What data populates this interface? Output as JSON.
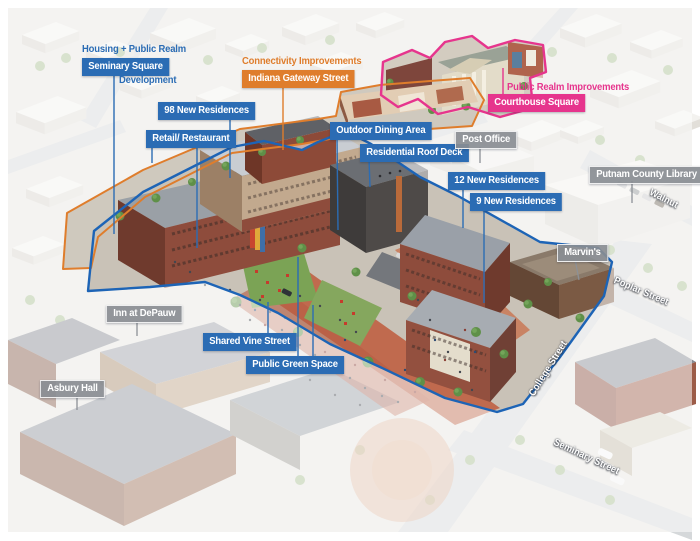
{
  "colors": {
    "callout_blue": "#2b6cb4",
    "callout_orange": "#df7d2c",
    "callout_pink": "#e6358d",
    "callout_gray": "#8d9196",
    "site_outline_blue": "#1d64b6"
  },
  "annotations": {
    "housing": {
      "heading": "Housing + Public Realm",
      "box": "Seminary Square",
      "sub": "Development"
    },
    "connectivity": {
      "heading": "Connectivity Improvements",
      "box": "Indiana Gateway Street"
    },
    "public_realm": {
      "heading": "Public Realm Improvements",
      "box": "Courthouse Square"
    }
  },
  "site_callouts": {
    "residences_98": "98 New Residences",
    "retail_restaurant": "Retail/ Restaurant",
    "outdoor_dining": "Outdoor Dining Area",
    "roof_deck": "Residential Roof Deck",
    "residences_12": "12 New Residences",
    "residences_9": "9 New Residences",
    "shared_vine": "Shared Vine Street",
    "green_space": "Public Green Space"
  },
  "context_callouts": {
    "post_office": "Post Office",
    "library": "Putnam County Library",
    "marvins": "Marvin's",
    "inn": "Inn at DePauw",
    "asbury": "Asbury Hall"
  },
  "streets": {
    "walnut": "Walnut",
    "poplar": "Poplar Street",
    "college": "College Street",
    "seminary": "Seminary Street"
  }
}
